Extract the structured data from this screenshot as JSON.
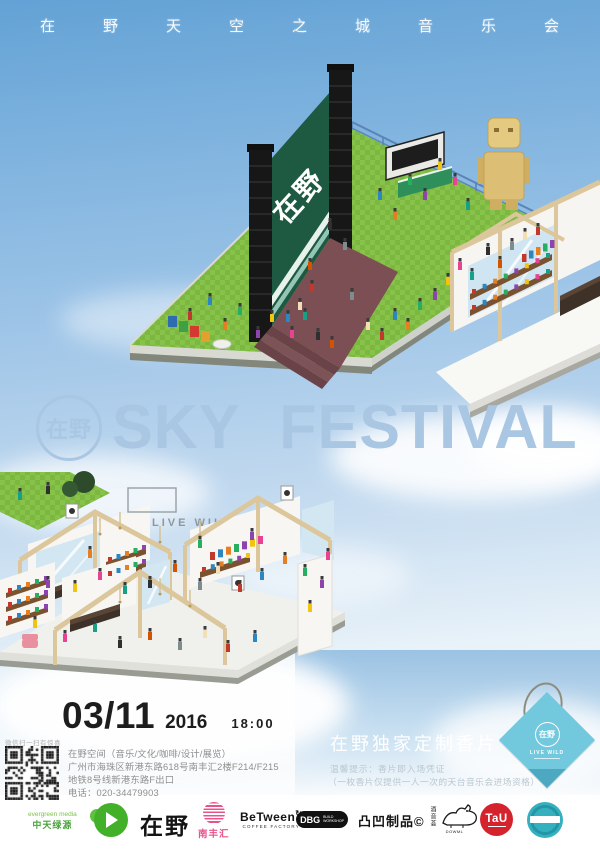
{
  "header": {
    "title_cn": "在野天空之城音乐会"
  },
  "hero": {
    "badge": "在野",
    "title": "SKY FESTIVAL"
  },
  "stage": {
    "banner": "在野"
  },
  "market": {
    "sign": "LIVE WILD"
  },
  "info": {
    "date": "03/11",
    "year": "2016",
    "time": "18:00",
    "qr_caption": "微信扫一扫有惊喜",
    "venue_lines": [
      "在野空间（音乐/文化/咖啡/设计/展览）",
      "广州市海珠区新港东路618号南丰汇2楼F214/F215",
      "地铁8号线新港东路F出口",
      "电话：020-34479903"
    ]
  },
  "promo": {
    "title": "在野独家定制香片",
    "note1": "温馨提示：香片即入场凭证",
    "note2": "（一枚香片仅提供一人一次的天台音乐会进场资格）"
  },
  "tag": {
    "badge": "在野",
    "label": "LIVE WILD"
  },
  "sponsors": {
    "evergreen_line1": "evergreen media",
    "evergreen_line2": "中天绿源",
    "zaiye": "在野",
    "nanfenghui": "南丰汇",
    "between_line1": "BeTween",
    "between_arrow": "↻",
    "between_line2": "COFFEE FACTORY",
    "dbg": "DBG",
    "dbg_sub1": "BUILD",
    "dbg_sub2": "WORKSHOP",
    "tuao": "凸凹制品©",
    "cat_vertical": "酒音荟",
    "cat_caption": "DOWML",
    "tau": "TaU"
  },
  "colors": {
    "sky_top": "#63a2d5",
    "hero_blue": "#a9c6e3",
    "grass": "#7cb83f",
    "stage_green": "#1e5a42",
    "tag_blue": "#72c8dc",
    "pink": "#e8538c",
    "red": "#d5232e",
    "teal": "#35b0bf"
  }
}
